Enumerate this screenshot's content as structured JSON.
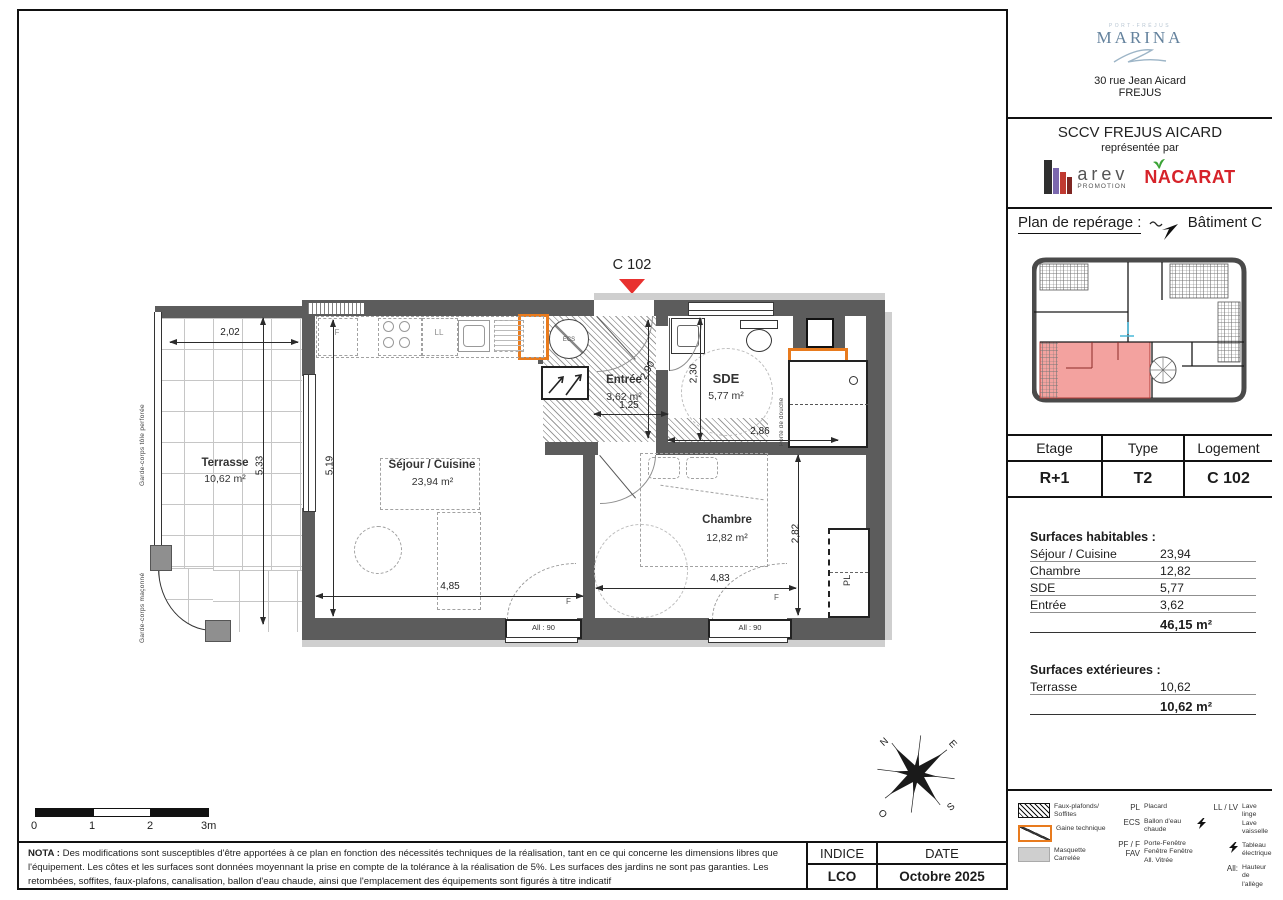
{
  "branding": {
    "marina_top": "PORT-FRÉJUS",
    "marina": "MARINA",
    "address1": "30 rue Jean Aicard",
    "address2": "FREJUS",
    "sccv_title": "SCCV FREJUS AICARD",
    "sccv_subtitle": "représentée par",
    "arev_name": "arev",
    "arev_sub": "PROMOTION",
    "nacarat": "NACARAT"
  },
  "reperage": {
    "title": "Plan de repérage :",
    "batiment": "Bâtiment C"
  },
  "unit_table": {
    "headers": [
      "Etage",
      "Type",
      "Logement"
    ],
    "etage": "R+1",
    "type": "T2",
    "logement": "C 102"
  },
  "surfaces": {
    "habitables_title": "Surfaces habitables :",
    "habitables": [
      {
        "label": "Séjour / Cuisine",
        "value": "23,94"
      },
      {
        "label": "Chambre",
        "value": "12,82"
      },
      {
        "label": "SDE",
        "value": "5,77"
      },
      {
        "label": "Entrée",
        "value": "3,62"
      }
    ],
    "habitables_total": "46,15 m²",
    "exterieures_title": "Surfaces extérieures :",
    "exterieures": [
      {
        "label": "Terrasse",
        "value": "10,62"
      }
    ],
    "exterieures_total": "10,62 m²"
  },
  "legend": {
    "swatches": [
      {
        "icon": "hatch-swatch",
        "label": "Faux-plafonds/ Soffites"
      },
      {
        "icon": "gaine-swatch",
        "label": "Gaine technique"
      },
      {
        "icon": "masquette-swatch",
        "label": "Masquette Carrelée"
      }
    ],
    "abbr1": [
      {
        "abbr": "PL",
        "label": "Placard"
      },
      {
        "abbr": "ECS",
        "label": "Ballon d'eau chaude"
      },
      {
        "abbr": "PF / F FAV",
        "label": "Porte-Fenêtre Fenêtre Fenêtre All. Vitrée"
      }
    ],
    "abbr2": [
      {
        "abbr": "LL / LV",
        "label": "Lave linge Lave vaisselle"
      },
      {
        "abbr": "",
        "label": "Tableau électrique"
      },
      {
        "abbr": "All:",
        "label": "Hauteur de l'allège"
      }
    ]
  },
  "nota": {
    "prefix": "NOTA :",
    "body": "Des modifications sont susceptibles d'être apportées à ce plan en fonction des nécessités techniques de la réalisation, tant en ce qui concerne les dimensions libres que l'équipement. Les côtes et les surfaces sont données moyennant la prise en compte de la tolérance à la réalisation de 5%. Les surfaces des jardins ne sont pas garanties. Les retombées, soffites, faux-plafons, canalisation, ballon d'eau chaude, ainsi que l'emplacement des équipements sont figurés à titre indicatif"
  },
  "revision": {
    "headers": [
      "INDICE",
      "DATE"
    ],
    "indice": "LCO",
    "date": "Octobre 2025"
  },
  "plan": {
    "unit_label": "C 102",
    "rooms": {
      "terrasse": {
        "name": "Terrasse",
        "area": "10,62 m²"
      },
      "sejour": {
        "name": "Séjour / Cuisine",
        "area": "23,94 m²"
      },
      "entree": {
        "name": "Entrée",
        "area": "3,62 m²"
      },
      "sde": {
        "name": "SDE",
        "area": "5,77 m²"
      },
      "chambre": {
        "name": "Chambre",
        "area": "12,82 m²"
      }
    },
    "dims": {
      "terrasse_w": "2,02",
      "terrasse_h": "5,33",
      "sejour_h": "5,19",
      "sejour_w": "4,85",
      "entree_w": "1,25",
      "entree_h": "2,90",
      "sde_h": "2,30",
      "sde_w": "2,86",
      "chambre_w": "4,83",
      "chambre_h": "2,82"
    },
    "labels": {
      "garde_corps_1": "Garde-corps tôle perforée",
      "garde_corps_2": "Garde-corps maçonné",
      "porte_douche": "Porte de douche",
      "ecs": "ECS",
      "fridge": "F",
      "ll": "LL",
      "pl": "PL",
      "window_f1": "F",
      "window_f2": "F",
      "allege1": "All : 90",
      "allege2": "All : 90"
    },
    "scalebar": [
      "0",
      "1",
      "2",
      "3m"
    ],
    "compass": {
      "n": "N",
      "e": "E",
      "s": "S",
      "o": "O"
    }
  },
  "colors": {
    "wall_gray": "#5c5c5c",
    "masquette_gray": "#cfcfcf",
    "accent_orange": "#e87b1e",
    "marker_red": "#e8312f",
    "unit_pink": "#f3a29f",
    "nacarat_red": "#d6232a",
    "nacarat_green": "#3aa335",
    "marina_blue": "#64829d"
  }
}
